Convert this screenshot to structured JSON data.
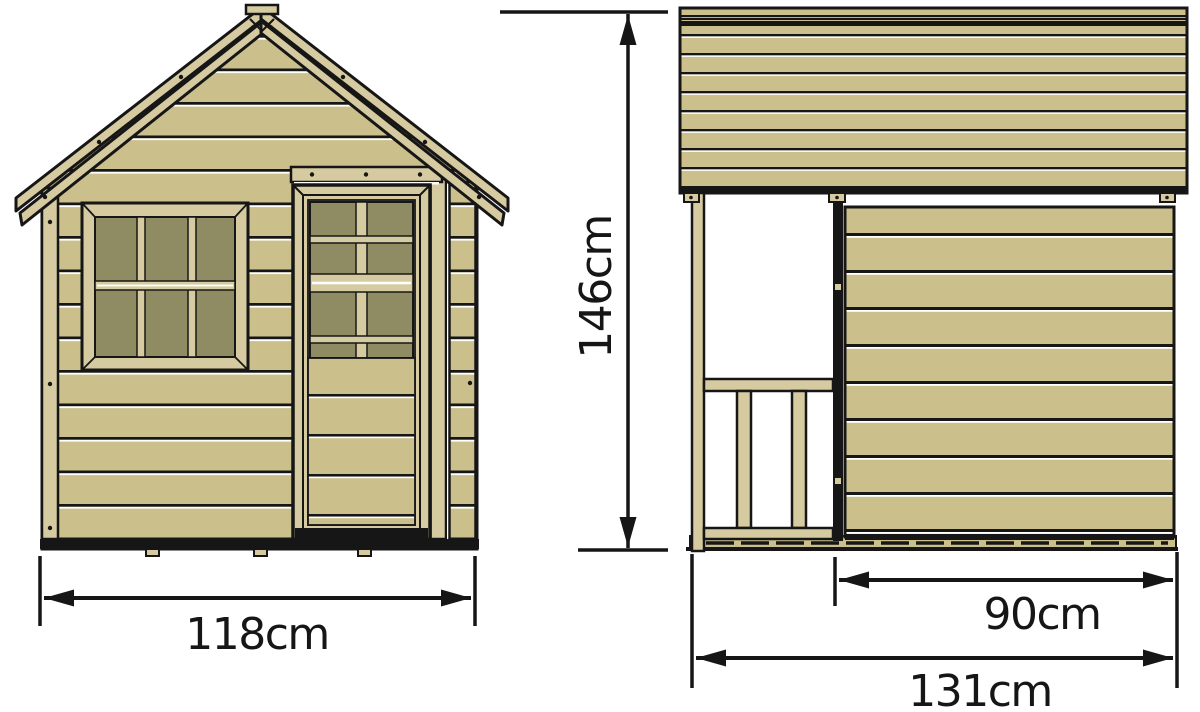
{
  "dimensions": {
    "front_width": {
      "label": "118cm"
    },
    "height": {
      "label": "146cm"
    },
    "side_wall_depth": {
      "label": "90cm"
    },
    "side_total_depth": {
      "label": "131cm"
    }
  },
  "colors": {
    "wood": "#cbbf8c",
    "wood_trim": "#d6cba0",
    "glass": "#8f8c63",
    "ink": "#161616",
    "background": "#ffffff"
  }
}
